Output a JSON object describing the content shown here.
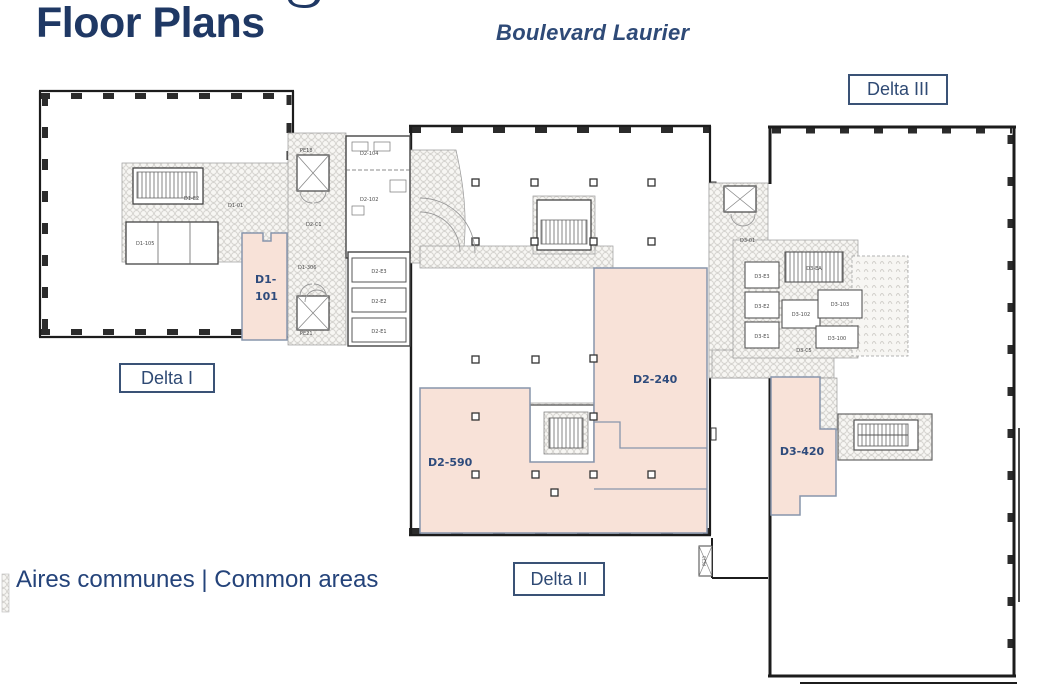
{
  "header": {
    "title": "Floor Plans",
    "subtitle": "Boulevard Laurier"
  },
  "legend": {
    "text": "Aires communes | Common areas"
  },
  "building_labels": {
    "delta1": "Delta I",
    "delta2": "Delta II",
    "delta3": "Delta III"
  },
  "suites": {
    "d1_101": {
      "line1": "D1-",
      "line2": "101"
    },
    "d2_590": {
      "label": "D2-590"
    },
    "d2_240": {
      "label": "D2-240"
    },
    "d3_420": {
      "label": "D3-420"
    }
  },
  "plan_labels": {
    "pe18": "PE18",
    "pe21": "PE21",
    "pe23": "PE23",
    "d1_01": "D1-01",
    "d1_e2": "D1-E2",
    "d1_105": "D1-105",
    "d1_306": "D1-306",
    "d2_c1": "D2-C1",
    "d2_104": "D2-104",
    "d2_102": "D2-102",
    "d2_e3": "D2-E3",
    "d2_e2": "D2-E2",
    "d2_e1": "D2-E1",
    "d3_01": "D3-01",
    "d3_ea": "D3-EA",
    "d3_e3": "D3-E3",
    "d3_e2": "D3-E2",
    "d3_e1": "D3-E1",
    "d3_103": "D3-103",
    "d3_102": "D3-102",
    "d3_100": "D3-100",
    "d3_c5": "D3-C5"
  },
  "colors": {
    "accent_navy": "#1F3864",
    "suite_fill": "#F8E2D8",
    "suite_border": "#8795AC",
    "suite_text": "#2E4B7C",
    "box_border": "#3A5276",
    "wall": "#1c1c1c",
    "hatch": "#d4d2ce"
  }
}
